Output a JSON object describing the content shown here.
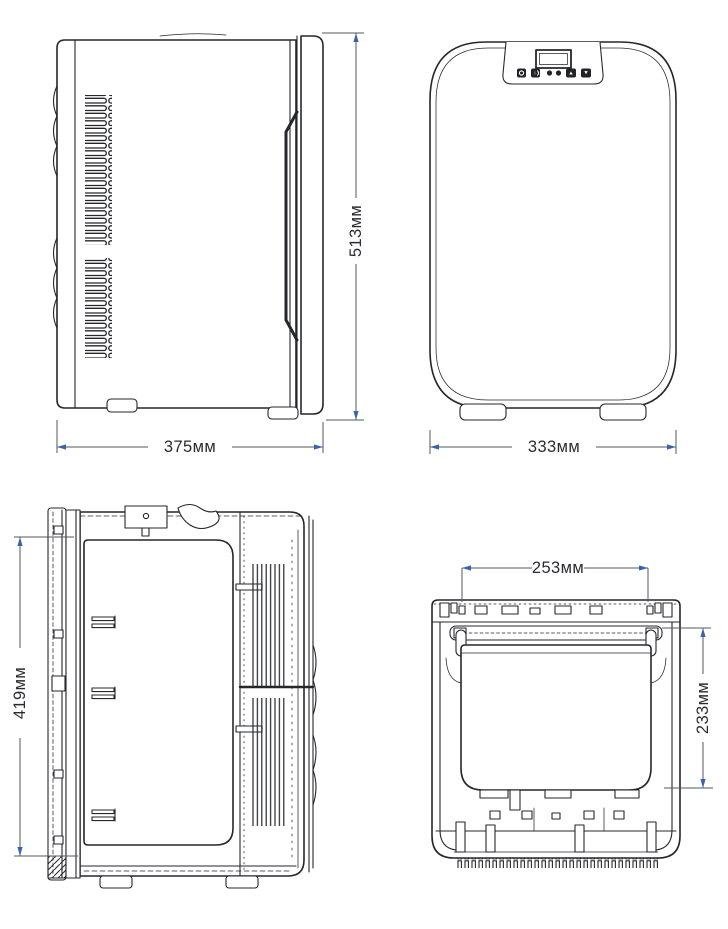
{
  "drawing": {
    "background": "#ffffff",
    "line_color": "#26272b",
    "dim_line_color": "#56575e",
    "arrow_color": "#3a63ac",
    "text_color": "#2b2c31"
  },
  "views": {
    "side_view": {
      "dims": {
        "width": "375мм",
        "height": "513мм"
      }
    },
    "front_view": {
      "dims": {
        "width": "333мм"
      }
    },
    "open_side_view": {
      "dims": {
        "height": "419мм"
      }
    },
    "top_view": {
      "dims": {
        "opening_width": "253мм",
        "opening_depth": "233мм"
      }
    }
  },
  "front_view_panel": {
    "display": "lcd-display",
    "button_icons": [
      "power-icon",
      "mode-icon",
      "led-dot",
      "led-dot",
      "up-arrow-icon",
      "down-arrow-icon"
    ]
  }
}
